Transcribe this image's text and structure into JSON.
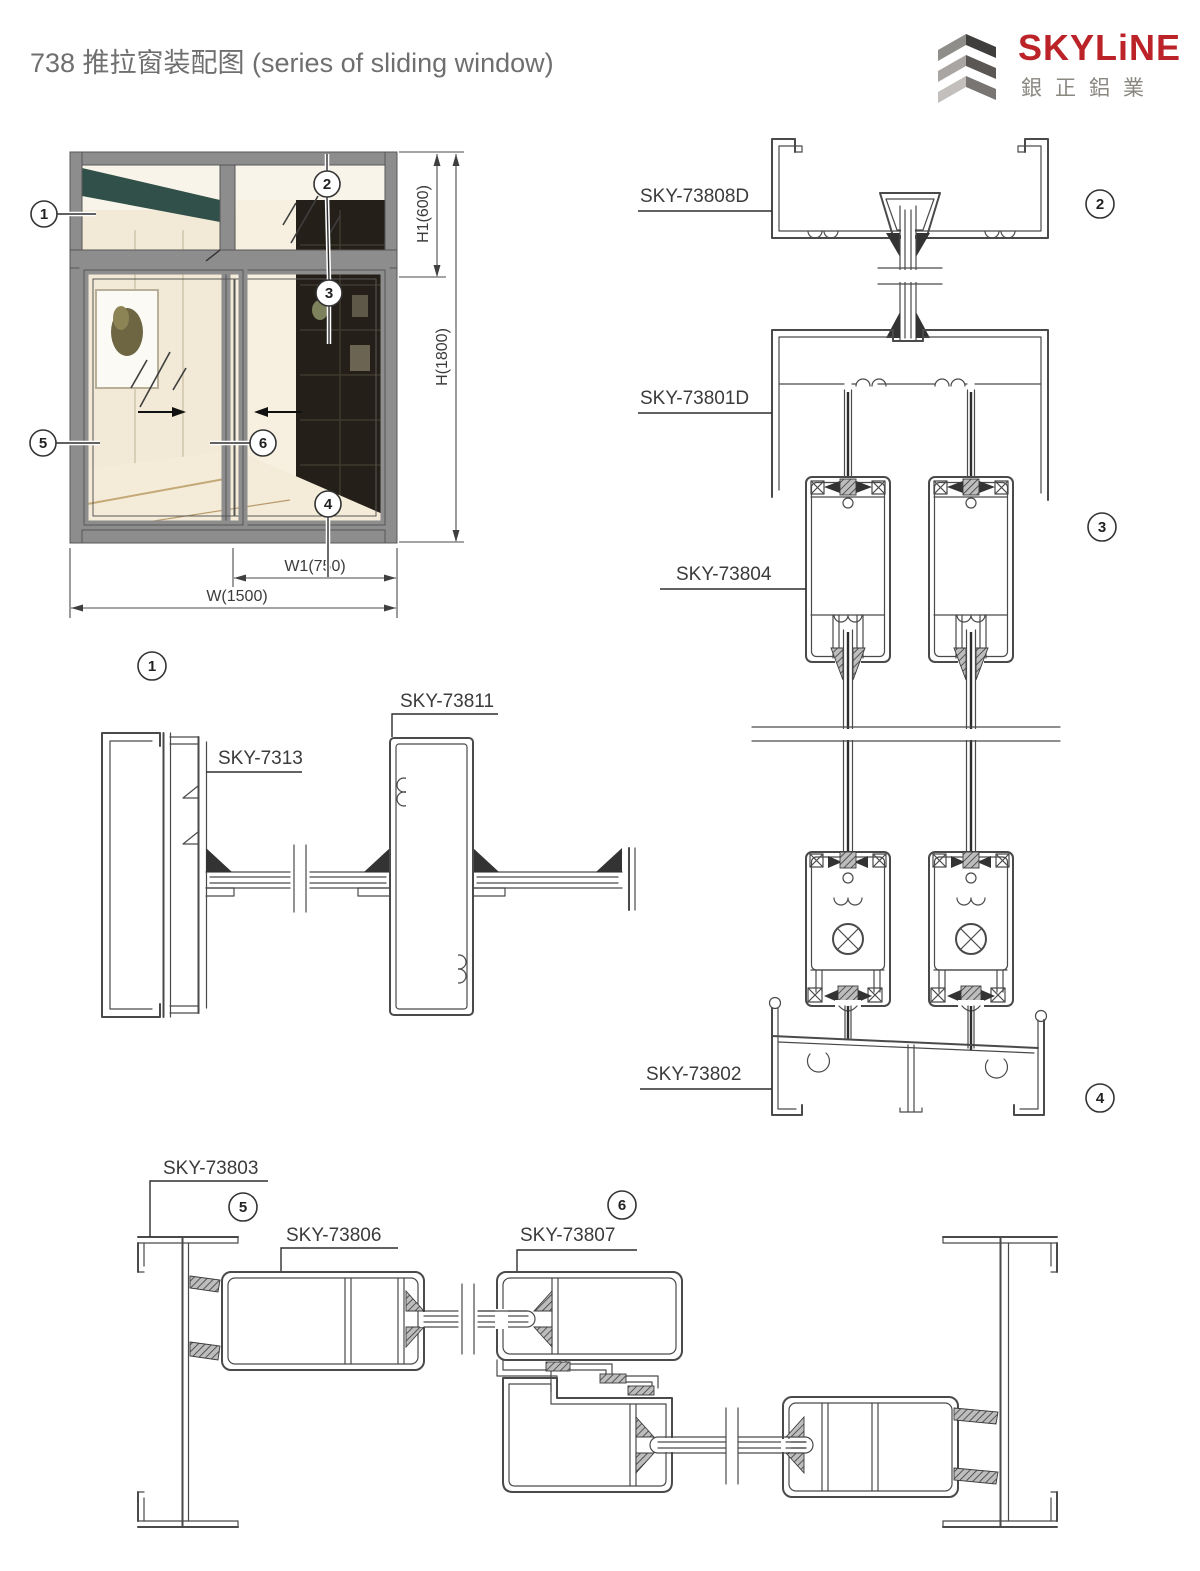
{
  "title": "738 推拉窗装配图 (series of sliding window)",
  "logo": {
    "brand": "SKYLiNE",
    "company": "銀正鋁業"
  },
  "parts": {
    "head_frame": "SKY-73808D",
    "transom": "SKY-73801D",
    "sash_vertical": "SKY-73804",
    "sill": "SKY-73802",
    "jamb_fixed": "SKY-7313",
    "mullion": "SKY-73811",
    "jamb_sliding": "SKY-73803",
    "sash_stile": "SKY-73806",
    "sash_interlock": "SKY-73807"
  },
  "dimensions": {
    "transom_height": "H1(600)",
    "total_height": "H(1800)",
    "sash_width": "W1(750)",
    "total_width": "W(1500)"
  },
  "balloons": {
    "n1": "1",
    "n2": "2",
    "n3": "3",
    "n4": "4",
    "n5": "5",
    "n6": "6"
  },
  "colors": {
    "frame_gray": "#8d8d8d",
    "line": "#4a4a4a",
    "brand_red": "#bb2329",
    "logo_gray": "#8b8781",
    "beam_teal": "#32504a",
    "shelf_dark": "#241f19"
  }
}
